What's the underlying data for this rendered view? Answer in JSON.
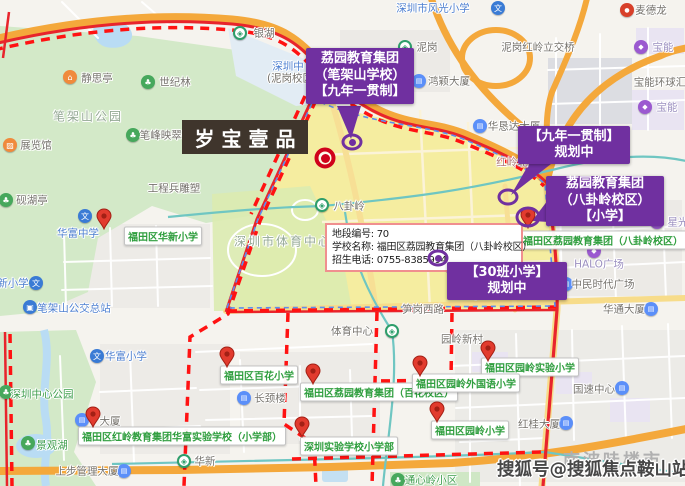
{
  "map": {
    "watermark": "搜狐号@搜狐焦点鞍山站",
    "background_label": "南波哇楼市",
    "project_marker": {
      "label": "岁宝壹品"
    },
    "info_box": {
      "rows": [
        {
          "label": "地段编号:",
          "value": "70"
        },
        {
          "label": "学校名称:",
          "value": "福田区荔园教育集团（八卦岭校区）"
        },
        {
          "label": "招生电话:",
          "value": "0755-8385994"
        }
      ]
    },
    "callouts": [
      {
        "id": "c1",
        "lines": [
          "荔园教育集团",
          "（笔架山学校）",
          "【九年一贯制】"
        ],
        "x": 306,
        "y": 48,
        "w": 108,
        "h": 56
      },
      {
        "id": "c2",
        "lines": [
          "【九年一贯制】",
          "规划中"
        ],
        "x": 518,
        "y": 126,
        "w": 112,
        "h": 38
      },
      {
        "id": "c3",
        "lines": [
          "荔园教育集团",
          "（八卦岭校区）",
          "【小学】"
        ],
        "x": 546,
        "y": 176,
        "w": 118,
        "h": 50
      },
      {
        "id": "c4",
        "lines": [
          "【30班小学】",
          "规划中"
        ],
        "x": 447,
        "y": 262,
        "w": 120,
        "h": 38
      }
    ],
    "school_labels": [
      {
        "text": "福田区华新小学",
        "cx": 163,
        "cy": 236
      },
      {
        "text": "福田区百花小学",
        "cx": 259,
        "cy": 375
      },
      {
        "text": "福田区荔园教育集团（百花校区）",
        "cx": 379,
        "cy": 392
      },
      {
        "text": "福田区园岭实验小学",
        "cx": 530,
        "cy": 367
      },
      {
        "text": "福田区园岭外国语小学",
        "cx": 466,
        "cy": 383
      },
      {
        "text": "福田区园岭小学",
        "cx": 470,
        "cy": 430
      },
      {
        "text": "福田区红岭教育集团华富实验学校（小学部）",
        "cx": 182,
        "cy": 436
      },
      {
        "text": "深圳实验学校小学部",
        "cx": 349,
        "cy": 446
      },
      {
        "text": "福田区荔园教育集团（八卦岭校区）",
        "cx": 603,
        "cy": 240
      }
    ],
    "pins": [
      {
        "x": 104,
        "y": 229
      },
      {
        "x": 227,
        "y": 367
      },
      {
        "x": 313,
        "y": 384
      },
      {
        "x": 488,
        "y": 361
      },
      {
        "x": 420,
        "y": 376
      },
      {
        "x": 437,
        "y": 422
      },
      {
        "x": 93,
        "y": 427
      },
      {
        "x": 302,
        "y": 437
      },
      {
        "x": 528,
        "y": 228
      }
    ],
    "rings": [
      {
        "x": 352,
        "y": 142,
        "dot": true,
        "wide": false
      },
      {
        "x": 508,
        "y": 197,
        "dot": false,
        "wide": false
      },
      {
        "x": 438,
        "y": 258,
        "dot": true,
        "wide": false
      },
      {
        "x": 528,
        "y": 217,
        "dot": false,
        "wide": true
      }
    ],
    "target_marker": {
      "x": 325,
      "y": 158
    },
    "icon_glyphs": {
      "school": "文",
      "metro": "◈",
      "park": "♣",
      "building": "▤",
      "bus": "▣",
      "shopping": "◆",
      "pavilion": "⌂",
      "museum": "▨",
      "store": "●"
    },
    "pois": [
      {
        "name": "深圳市风光小学",
        "icon": "school",
        "ix": 498,
        "iy": 8,
        "lx": 433,
        "ly": 8,
        "color": "blue"
      },
      {
        "name": "银湖",
        "icon": "metro",
        "ix": 240,
        "iy": 33,
        "lx": 264,
        "ly": 33,
        "color": "grey"
      },
      {
        "name": "泥岗",
        "icon": "metro",
        "ix": 405,
        "iy": 47,
        "lx": 427,
        "ly": 47,
        "color": "grey"
      },
      {
        "name": "泥岗红岭立交桥",
        "lx": 538,
        "ly": 47,
        "color": "grey"
      },
      {
        "name": "麦德龙",
        "icon": "store",
        "ix": 627,
        "iy": 10,
        "lx": 651,
        "ly": 10,
        "color": "grey"
      },
      {
        "name": "宝能",
        "icon": "shopping",
        "ix": 641,
        "iy": 47,
        "lx": 663,
        "ly": 47,
        "color": "purple"
      },
      {
        "name": "宝能环球汇",
        "lx": 660,
        "ly": 82,
        "color": "grey"
      },
      {
        "name": "宝能",
        "icon": "shopping",
        "ix": 645,
        "iy": 107,
        "lx": 667,
        "ly": 107,
        "color": "purple"
      },
      {
        "name": "华恳达大厦",
        "icon": "building",
        "ix": 480,
        "iy": 126,
        "lx": 514,
        "ly": 126,
        "color": "grey"
      },
      {
        "name": "鸿颖大厦",
        "icon": "building",
        "ix": 419,
        "iy": 81,
        "lx": 449,
        "ly": 81,
        "color": "grey"
      },
      {
        "name": "深圳中",
        "lx": 288,
        "ly": 66,
        "color": "blue"
      },
      {
        "name": "(泥岗校区",
        "lx": 290,
        "ly": 78,
        "color": "grey"
      },
      {
        "name": "静思亭",
        "icon": "pavilion",
        "ix": 70,
        "iy": 77,
        "lx": 97,
        "ly": 78,
        "color": "grey"
      },
      {
        "name": "世纪林",
        "icon": "park",
        "ix": 148,
        "iy": 82,
        "lx": 175,
        "ly": 82,
        "color": "grey"
      },
      {
        "name": "笔架山公园",
        "lx": 88,
        "ly": 116,
        "color": "park-grey",
        "size": 12
      },
      {
        "name": "笔峰映翠亭",
        "icon": "park",
        "ix": 133,
        "iy": 135,
        "lx": 166,
        "ly": 135,
        "color": "grey"
      },
      {
        "name": "展览馆",
        "icon": "museum",
        "ix": 10,
        "iy": 145,
        "lx": 36,
        "ly": 145,
        "color": "grey"
      },
      {
        "name": "砚湖亭",
        "icon": "park",
        "ix": 6,
        "iy": 200,
        "lx": 32,
        "ly": 200,
        "color": "grey"
      },
      {
        "name": "工程兵雕塑",
        "lx": 174,
        "ly": 188,
        "color": "grey"
      },
      {
        "name": "八卦岭",
        "icon": "metro",
        "ix": 322,
        "iy": 205,
        "lx": 349,
        "ly": 206,
        "color": "grey"
      },
      {
        "name": "深圳市体育中心",
        "lx": 283,
        "ly": 241,
        "color": "park-grey",
        "size": 12
      },
      {
        "name": "华富中学",
        "icon": "school",
        "ix": 85,
        "iy": 216,
        "lx": 78,
        "ly": 233,
        "color": "blue"
      },
      {
        "name": "新小学",
        "icon": "school",
        "ix": 36,
        "iy": 283,
        "lx": 13,
        "ly": 283,
        "color": "blue"
      },
      {
        "name": "笔架山公交总站",
        "icon": "bus",
        "ix": 30,
        "iy": 307,
        "lx": 74,
        "ly": 308,
        "color": "blue"
      },
      {
        "name": "体育中心",
        "icon": "metro",
        "ix": 392,
        "iy": 331,
        "lx": 352,
        "ly": 331,
        "color": "grey"
      },
      {
        "name": "笋岗西路",
        "lx": 423,
        "ly": 309,
        "color": "grey"
      },
      {
        "name": "红岭北",
        "lx": 512,
        "ly": 162,
        "color": "road-red"
      },
      {
        "name": "园岭新村",
        "lx": 462,
        "ly": 339,
        "color": "grey"
      },
      {
        "name": "长颈楼",
        "icon": "building",
        "ix": 244,
        "iy": 398,
        "lx": 270,
        "ly": 398,
        "color": "grey"
      },
      {
        "name": "华富小学",
        "icon": "school",
        "ix": 97,
        "iy": 356,
        "lx": 126,
        "ly": 356,
        "color": "blue"
      },
      {
        "name": "深圳中心公园",
        "icon": "park",
        "ix": 6,
        "iy": 392,
        "lx": 42,
        "ly": 394,
        "color": "green"
      },
      {
        "name": "景观湖",
        "icon": "park",
        "ix": 28,
        "iy": 443,
        "lx": 52,
        "ly": 445,
        "color": "green"
      },
      {
        "name": "上步管理大厦",
        "icon": "building",
        "ix": 124,
        "iy": 471,
        "lx": 87,
        "ly": 471,
        "color": "grey"
      },
      {
        "name": "大厦",
        "icon": "building",
        "ix": 82,
        "iy": 420,
        "lx": 110,
        "ly": 421,
        "color": "grey"
      },
      {
        "name": "华新",
        "icon": "metro",
        "ix": 184,
        "iy": 461,
        "lx": 205,
        "ly": 461,
        "color": "grey"
      },
      {
        "name": "通心岭小区",
        "icon": "park",
        "ix": 398,
        "iy": 480,
        "lx": 431,
        "ly": 480,
        "color": "green"
      },
      {
        "name": "景园大厦",
        "icon": "building",
        "ix": 501,
        "iy": 368,
        "lx": 531,
        "ly": 368,
        "color": "grey"
      },
      {
        "name": "国速中心",
        "icon": "building",
        "ix": 622,
        "iy": 388,
        "lx": 594,
        "ly": 389,
        "color": "grey"
      },
      {
        "name": "红桂大厦",
        "icon": "building",
        "ix": 566,
        "iy": 423,
        "lx": 539,
        "ly": 424,
        "color": "grey"
      },
      {
        "name": "华通大厦",
        "icon": "building",
        "ix": 651,
        "iy": 309,
        "lx": 624,
        "ly": 309,
        "color": "grey"
      },
      {
        "name": "HALO广场",
        "icon": "shopping",
        "ix": 594,
        "iy": 251,
        "lx": 599,
        "ly": 264,
        "color": "purple"
      },
      {
        "name": "中民时代广场",
        "icon": "building",
        "ix": 566,
        "iy": 284,
        "lx": 603,
        "ly": 284,
        "color": "grey"
      },
      {
        "name": "星光",
        "icon": "shopping",
        "ix": 657,
        "iy": 222,
        "lx": 678,
        "ly": 222,
        "color": "purple"
      }
    ],
    "colors": {
      "callout_purple": "#7030a0",
      "school_label_green": "#2f9e3e",
      "boundary_red": "#e8242c",
      "dashed_red": "#ff1212",
      "district_yellow": "#f5e870",
      "pin_red": "#e23b2e",
      "ring_purple": "#7030a0",
      "target_red": "#d0021b",
      "park_green": "#d3e9c8",
      "highway_orange": "#f4a83b",
      "metro_teal": "#6fc6c2",
      "water_blue": "#b9dcf4",
      "info_border_pink": "#f08f8f",
      "project_label_bg": "#3f352c",
      "watermark_grey": "#474747"
    }
  }
}
